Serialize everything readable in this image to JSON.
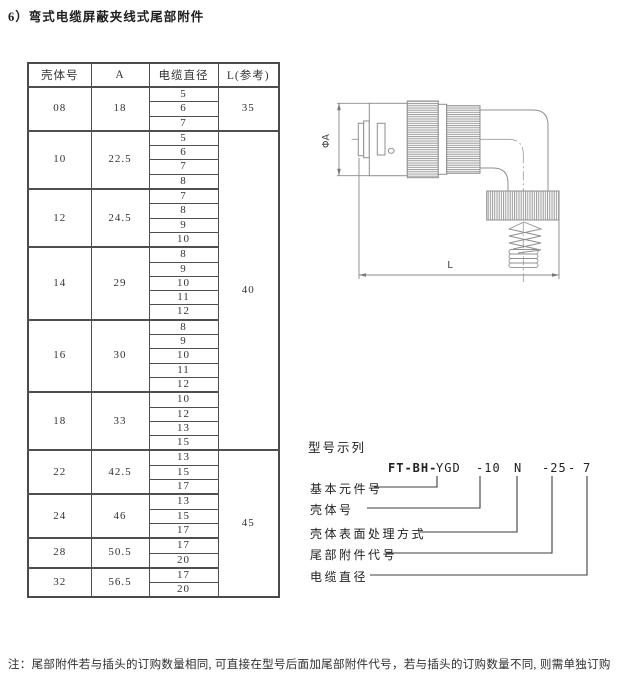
{
  "page": {
    "title": "6）弯式电缆屏蔽夹线式尾部附件",
    "note": "注：尾部附件若与插头的订购数量相同, 可直接在型号后面加尾部附件代号，若与插头的订购数量不同, 则需单独订购"
  },
  "table": {
    "headers": [
      "壳体号",
      "A",
      "电缆直径",
      "L(参考)"
    ],
    "groups": [
      {
        "shell": "08",
        "a": "18",
        "diameters": [
          "5",
          "6",
          "7"
        ]
      },
      {
        "shell": "10",
        "a": "22.5",
        "diameters": [
          "5",
          "6",
          "7",
          "8"
        ]
      },
      {
        "shell": "12",
        "a": "24.5",
        "diameters": [
          "7",
          "8",
          "9",
          "10"
        ]
      },
      {
        "shell": "14",
        "a": "29",
        "diameters": [
          "8",
          "9",
          "10",
          "11",
          "12"
        ]
      },
      {
        "shell": "16",
        "a": "30",
        "diameters": [
          "8",
          "9",
          "10",
          "11",
          "12"
        ]
      },
      {
        "shell": "18",
        "a": "33",
        "diameters": [
          "10",
          "12",
          "13",
          "15"
        ]
      },
      {
        "shell": "22",
        "a": "42.5",
        "diameters": [
          "13",
          "15",
          "17"
        ]
      },
      {
        "shell": "24",
        "a": "46",
        "diameters": [
          "13",
          "15",
          "17"
        ]
      },
      {
        "shell": "28",
        "a": "50.5",
        "diameters": [
          "17",
          "20"
        ]
      },
      {
        "shell": "32",
        "a": "56.5",
        "diameters": [
          "17",
          "20"
        ]
      }
    ],
    "l_column": [
      {
        "value": "35",
        "shells": [
          "08"
        ]
      },
      {
        "value": "40",
        "shells": [
          "10",
          "12",
          "14",
          "16",
          "18"
        ]
      },
      {
        "value": "45",
        "shells": [
          "22",
          "24",
          "28",
          "32"
        ]
      }
    ]
  },
  "drawing": {
    "dim_vertical": "ΦA",
    "dim_horizontal": "L"
  },
  "model": {
    "section_title": "型号示列",
    "code": [
      {
        "text": "FT-BH-",
        "bold": true
      },
      {
        "text": "YGD",
        "bold": false
      },
      {
        "text": "-10",
        "bold": false
      },
      {
        "text": "N",
        "bold": false
      },
      {
        "text": "-25",
        "bold": false
      },
      {
        "text": "-",
        "bold": false
      },
      {
        "text": "7",
        "bold": false
      }
    ],
    "labels": [
      "基本元件号",
      "壳体号",
      "壳体表面处理方式",
      "尾部附件代号",
      "电缆直径"
    ]
  }
}
